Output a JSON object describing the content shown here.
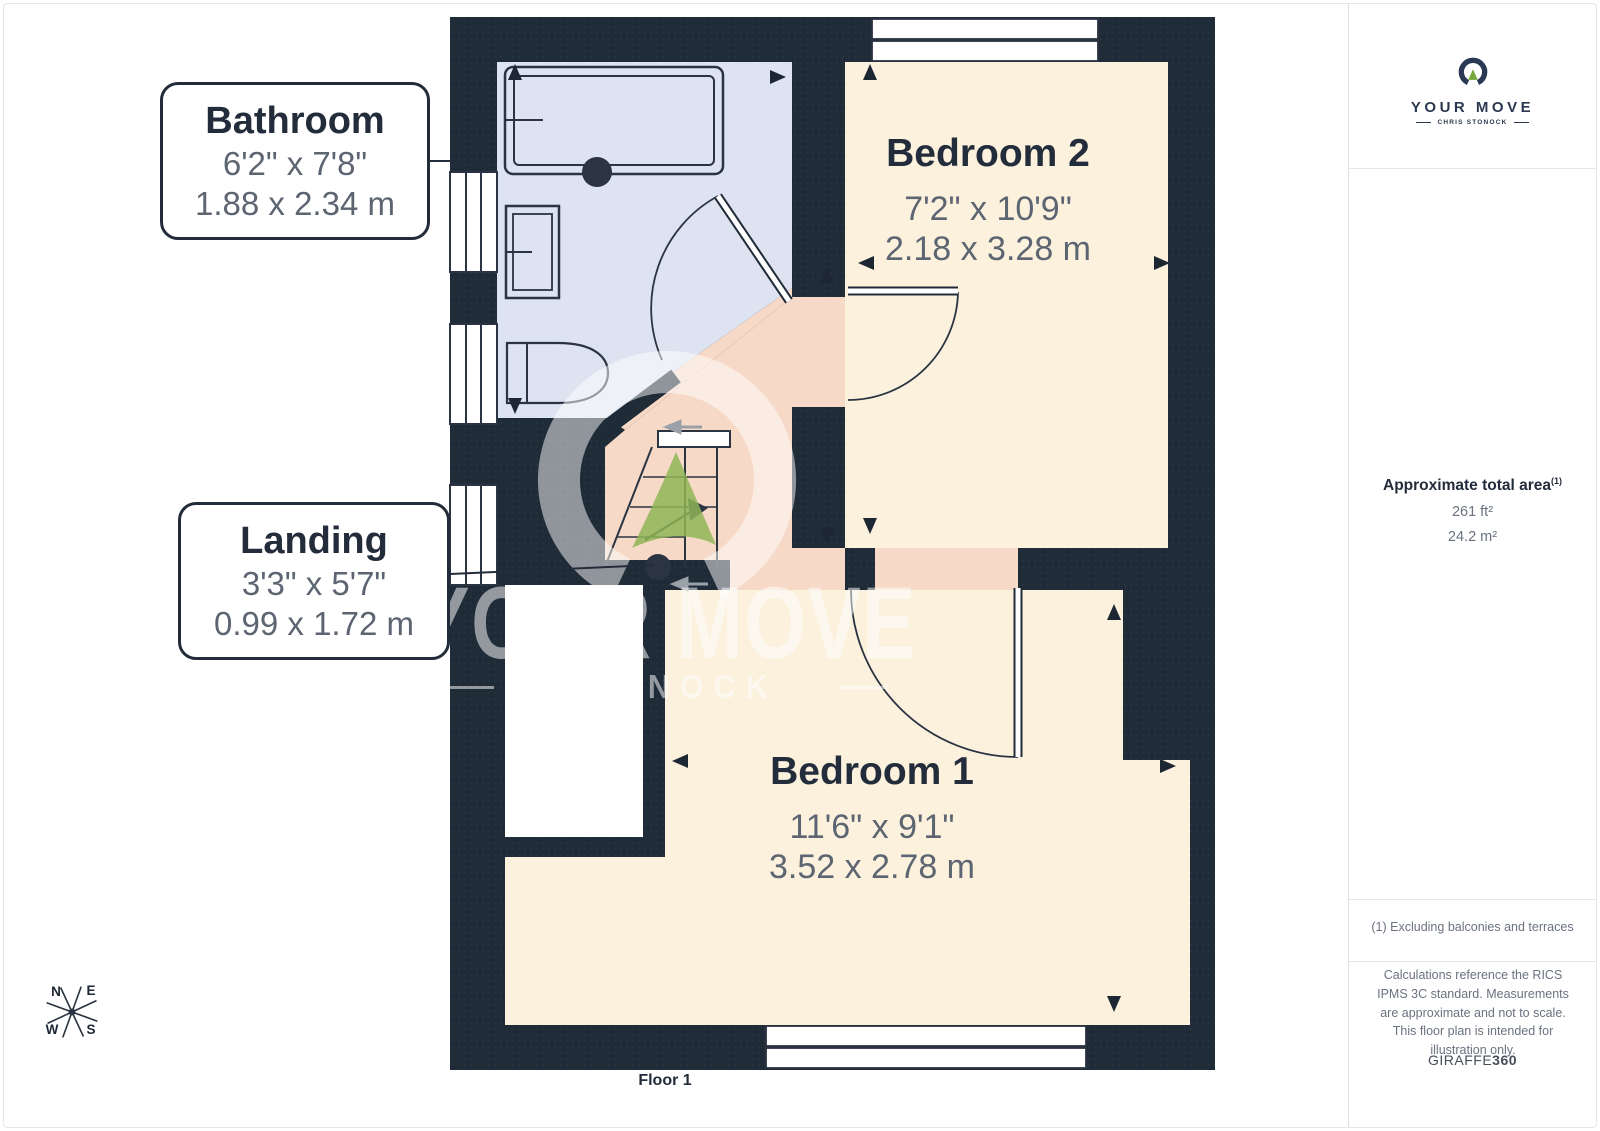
{
  "plan": {
    "floor_label": "Floor 1",
    "rooms": [
      {
        "name": "Bathroom",
        "dims_imperial": "6'2\" x 7'8\"",
        "dims_metric": "1.88 x 2.34 m"
      },
      {
        "name": "Bedroom 2",
        "dims_imperial": "7'2\" x 10'9\"",
        "dims_metric": "2.18 x 3.28 m"
      },
      {
        "name": "Landing",
        "dims_imperial": "3'3\" x 5'7\"",
        "dims_metric": "0.99 x 1.72 m"
      },
      {
        "name": "Bedroom 1",
        "dims_imperial": "11'6\" x 9'1\"",
        "dims_metric": "3.52 x 2.78 m"
      }
    ],
    "compass": {
      "n": "N",
      "e": "E",
      "s": "S",
      "w": "W"
    }
  },
  "watermark": {
    "line1": "YOUR MOVE",
    "line2": "STONOCK"
  },
  "sidebar": {
    "logo": {
      "brand": "YOUR MOVE",
      "sub": "CHRIS STONOCK"
    },
    "area": {
      "title": "Approximate total area",
      "superscript": "(1)",
      "sqft": "261 ft²",
      "sqm": "24.2 m²"
    },
    "footnote": "(1) Excluding balconies and terraces",
    "disclaimer": "Calculations reference the RICS IPMS 3C standard. Measurements are approximate and not to scale. This floor plan is intended for illustration only.",
    "brand_footer": {
      "name": "GIRAFFE",
      "suffix": "360"
    }
  },
  "colors": {
    "wall": "#202b38",
    "bathroom": "#dde3f0",
    "bedroom": "#fbf1dd",
    "landing": "#f6d9c7",
    "accent_green": "#8fb557"
  }
}
